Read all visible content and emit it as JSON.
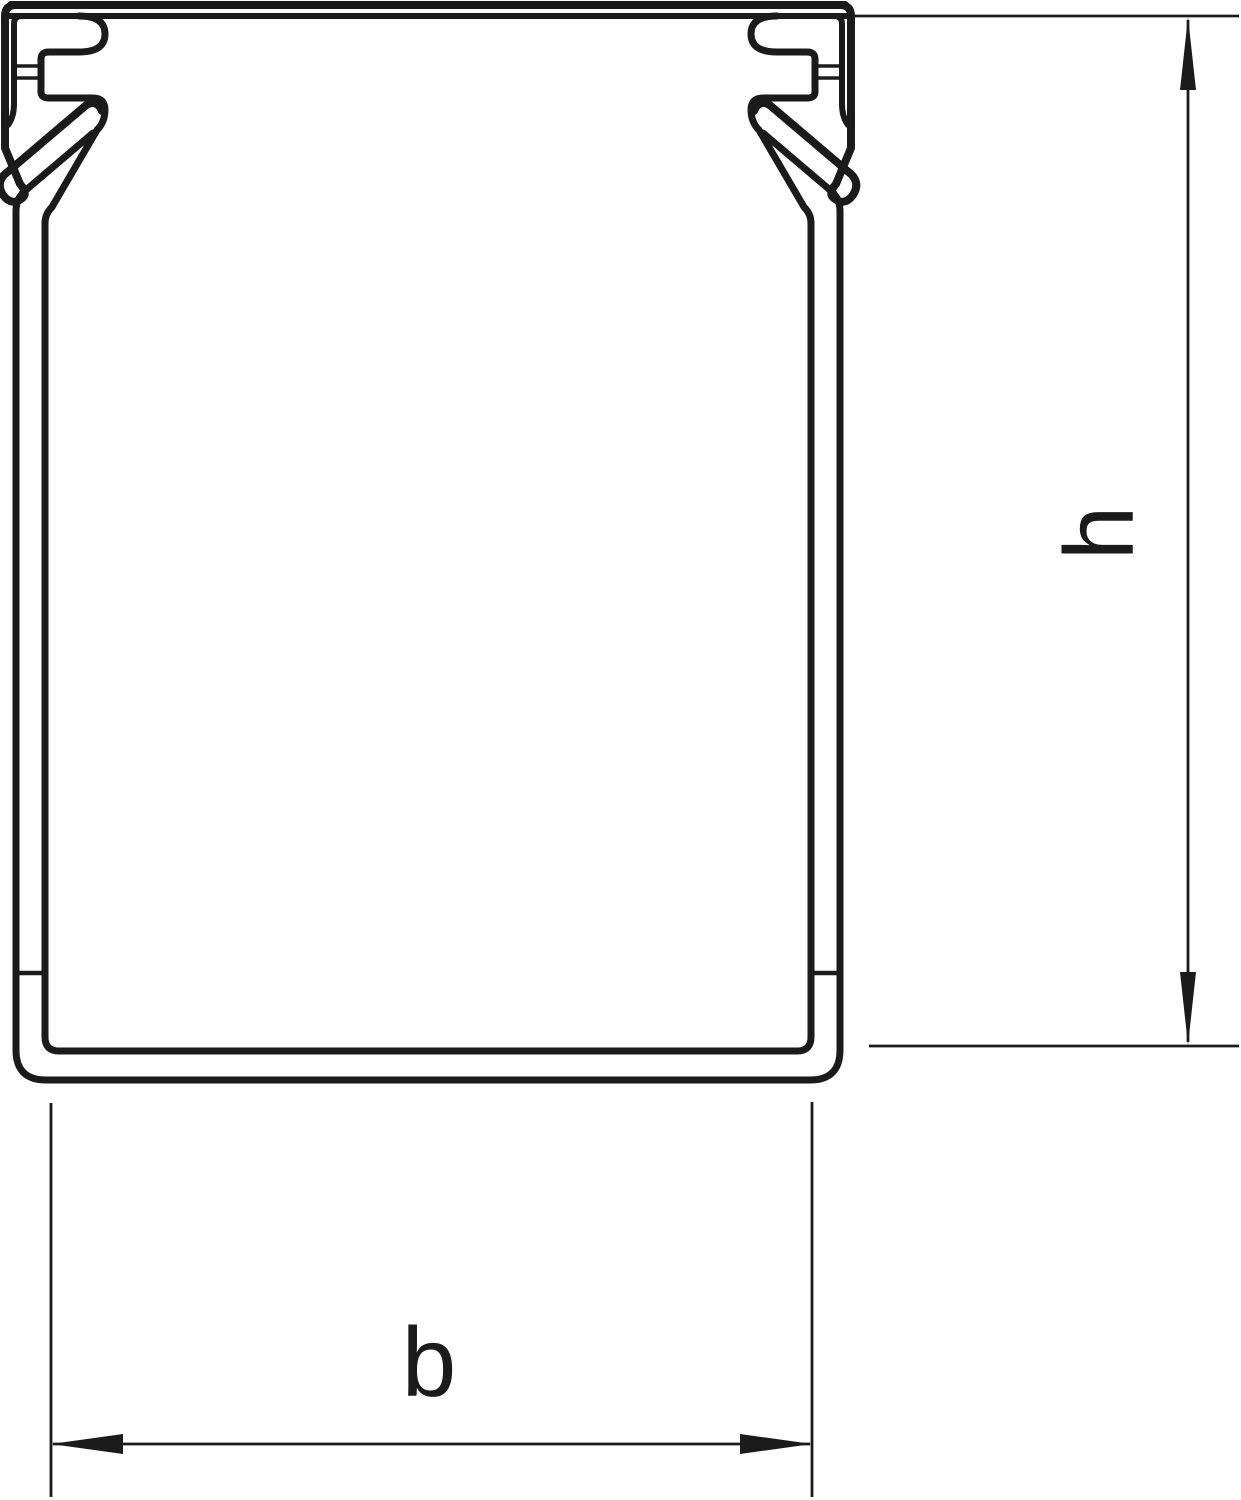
{
  "page": {
    "background": "#ffffff",
    "ink": "#1b1b1b"
  },
  "diagram": {
    "type": "technical-cross-section",
    "subject": "cable trunking duct profile with snap-on cover",
    "dimensions": {
      "height_label": "h",
      "width_label": "b"
    }
  }
}
